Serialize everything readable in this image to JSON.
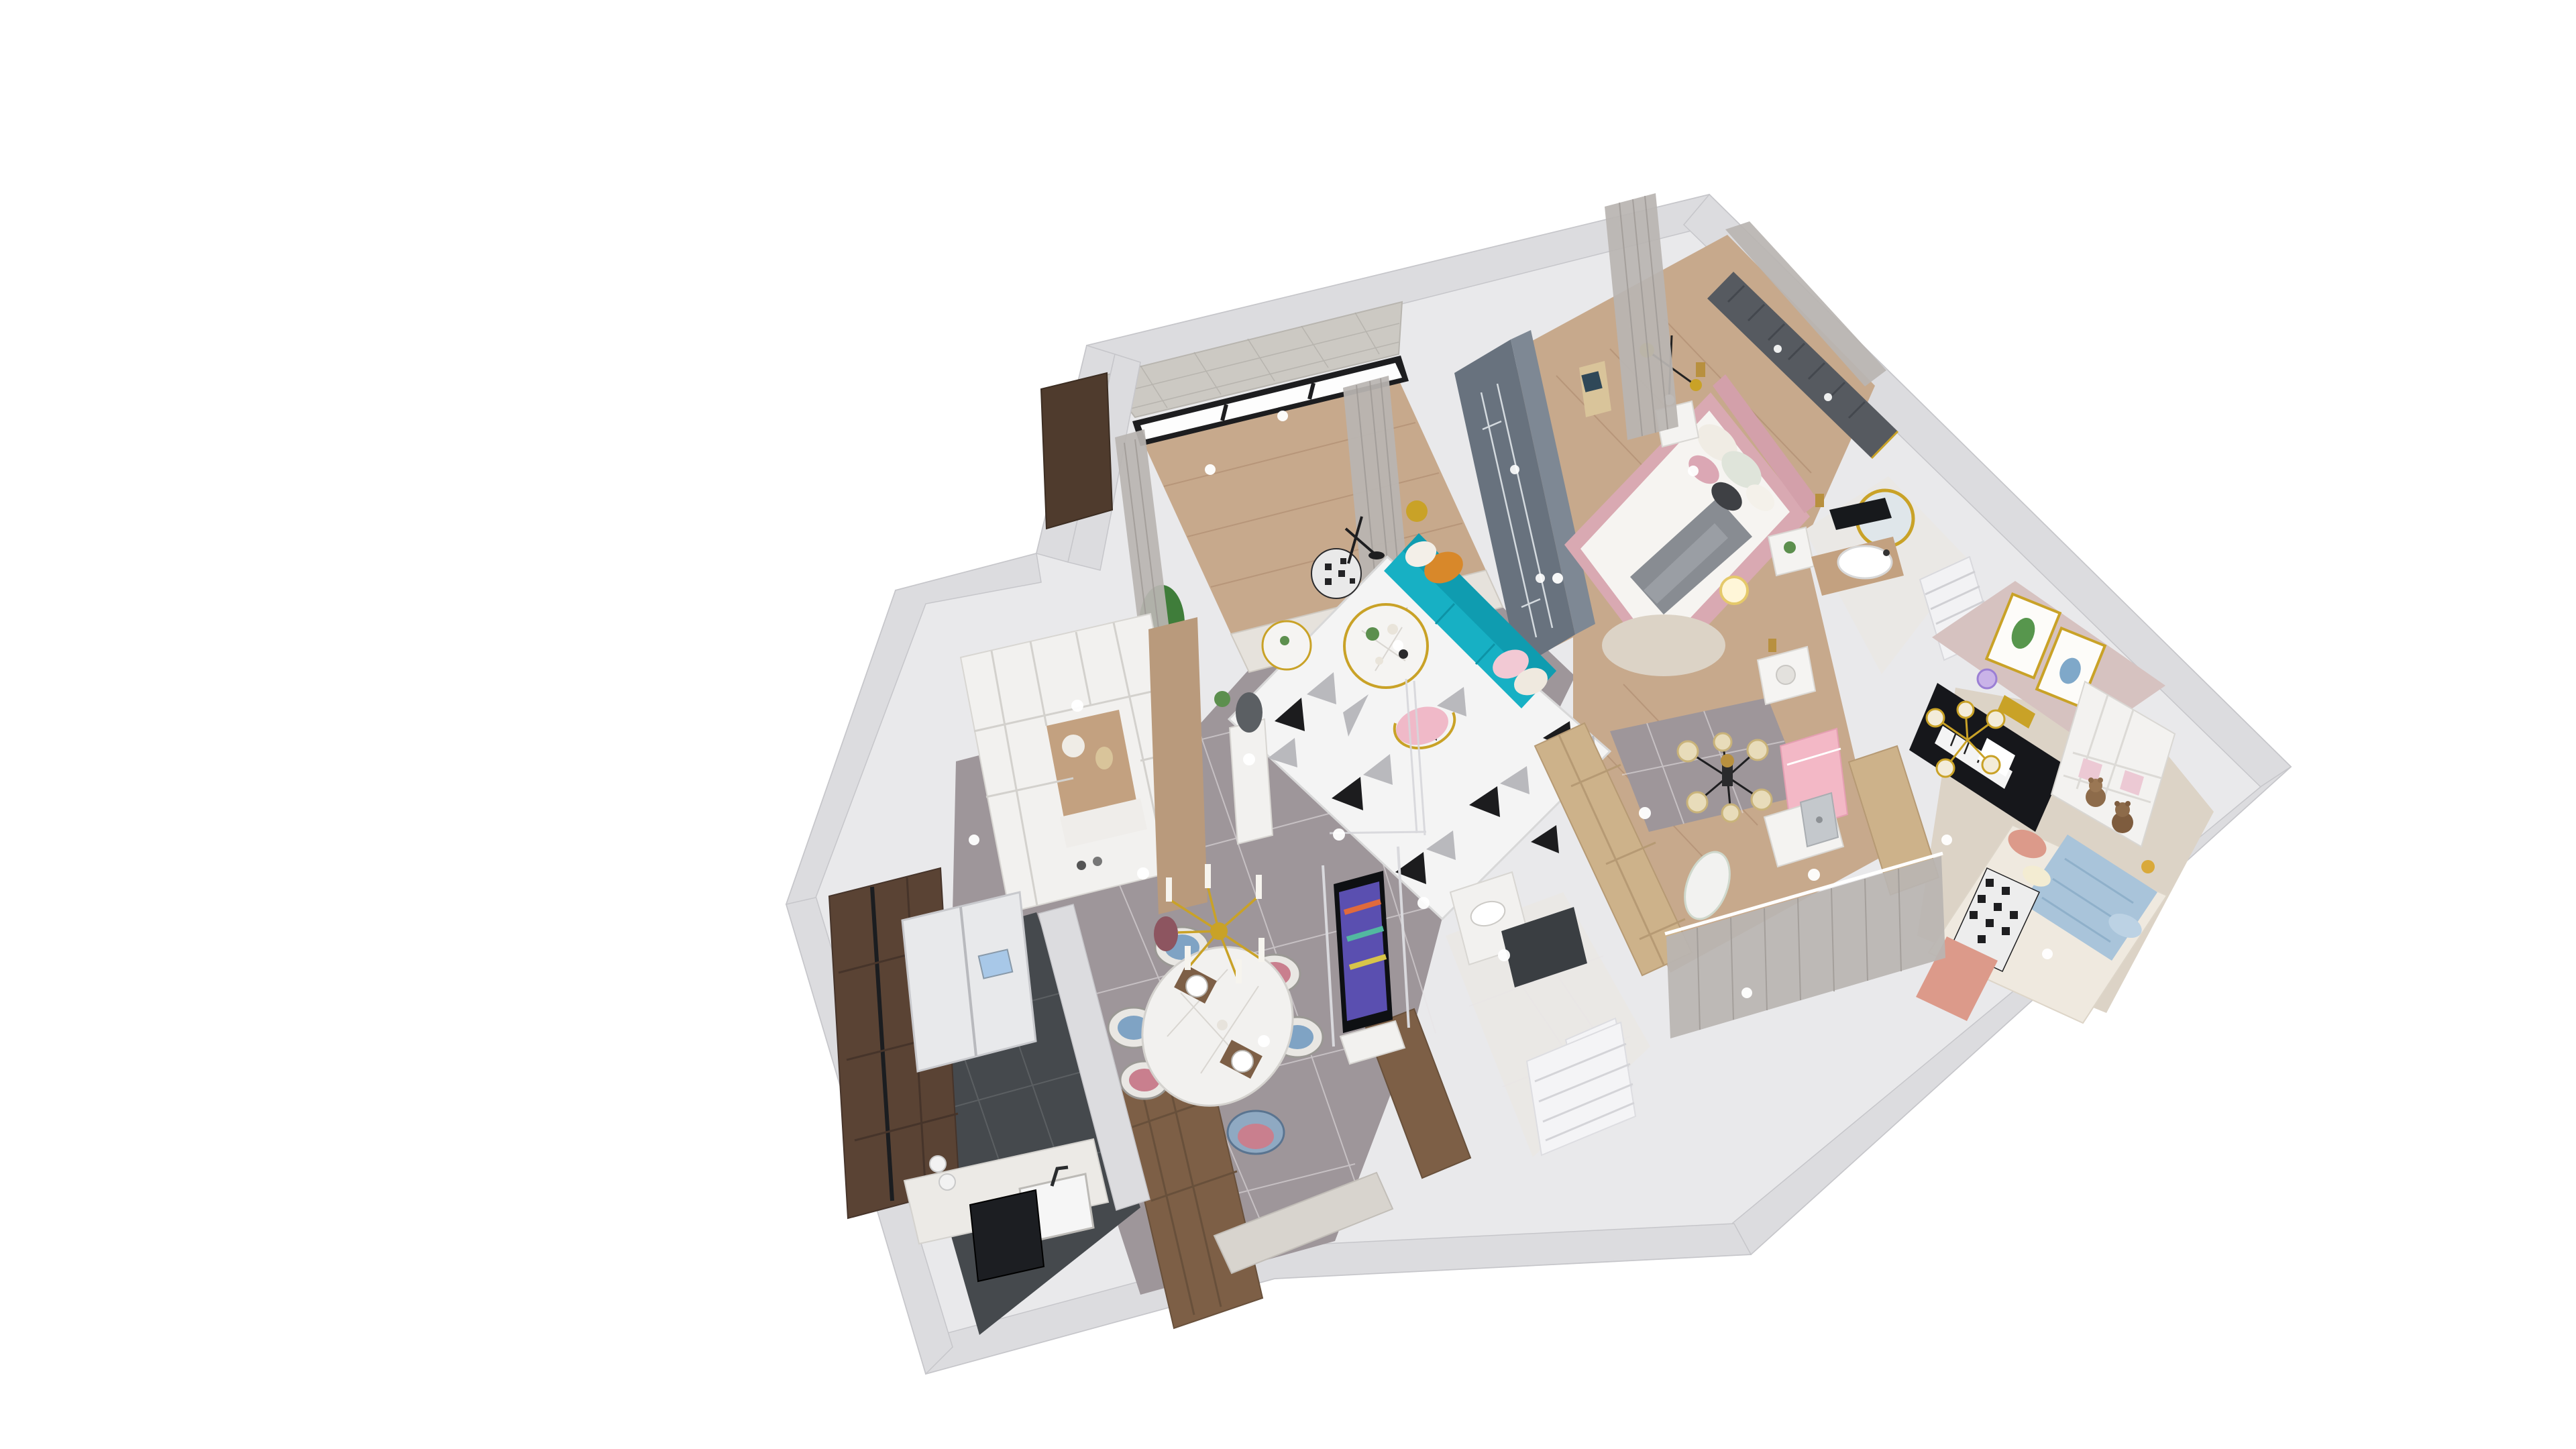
{
  "meta": {
    "title": "3D axonometric apartment floor plan render",
    "view": "top-down dollhouse cutaway, rotated ~20 degrees, white background",
    "visible_text": "none"
  },
  "palette": {
    "bg": "#ffffff",
    "wall": "#e9e9eb",
    "wallband": "#dcdcdf",
    "marble": "#9e969a",
    "darktile": "#45494d",
    "wood": "#c7a98c",
    "whitemarble": "#eae8e5",
    "carpet": "#dcd3c6",
    "bluegray": "#68727e",
    "teal": "#17b0c4",
    "gold": "#c9a227",
    "walnut": "#7d5f46",
    "pink": "#e7b6c0",
    "salmon": "#dc9a8a",
    "blue": "#a9c4da",
    "orange": "#d8882a",
    "piano": "#16171b",
    "slatwall": "#565a60"
  },
  "rooms": [
    {
      "name": "balcony",
      "floor": "wood planks",
      "items": [
        "floor-to-ceiling black-frame windows",
        "gray mosaic wall band",
        "sheer gray curtains",
        "potted plant",
        "dark walnut cabinet"
      ]
    },
    {
      "name": "living-room",
      "floor": "gray marble tile",
      "items": [
        "geometric black-white triangle rug",
        "teal three-seat sofa",
        "orange pillow",
        "pink and white pillows",
        "round marble coffee tables with gold legs",
        "houndstooth pouf",
        "pink wire chair with gold frame",
        "slate blue-gray feature wall",
        "floor lamp",
        "gold sphere decor"
      ]
    },
    {
      "name": "entry-hall",
      "floor": "gray marble tile",
      "items": [
        "white mudroom cabinet with wood niche",
        "hat and bag on hooks",
        "bench with shoes",
        "white pedestal with dark sculpture"
      ]
    },
    {
      "name": "master-bedroom",
      "floor": "wood planks",
      "items": [
        "pink upholstered bed with white duvet",
        "gray throw blanket",
        "pillow set",
        "dark gray slat headboard wall with gold trim",
        "white nightstand with photo frames",
        "black mobile chandelier with gold discs",
        "gold pendant lights",
        "cream round rug",
        "glowing drum lamp",
        "white side table with succulent",
        "window-bay seat",
        "gray curtains"
      ]
    },
    {
      "name": "master-bathroom",
      "floor": "white marble",
      "items": [
        "round gold-frame mirror",
        "white vessel sink on wood vanity",
        "black vanity tray",
        "white louvered shutters"
      ]
    },
    {
      "name": "kids-room",
      "floor": "cream carpet",
      "items": [
        "pink accent wall",
        "two gold-frame artworks (cactus, girl)",
        "black upright piano with sheet music",
        "gold bulb chandelier",
        "white cubby shelf with pink backs",
        "two teddy bears",
        "bed with houndstooth blanket",
        "salmon duvet",
        "light blue drape",
        "pillows"
      ]
    },
    {
      "name": "study-corridor",
      "floor": "wood planks with gray marble inset",
      "items": [
        "crystal chandelier",
        "white desk with silver computer",
        "pink wainscot wall",
        "light oak wardrobe band",
        "white appliance box with gold pendant",
        "gray partition curtain",
        "white slat radiator",
        "small white rug"
      ]
    },
    {
      "name": "second-bathroom",
      "floor": "white marble",
      "items": [
        "white marble vanity with basin",
        "dark stone counter slab",
        "white louvered partition screen"
      ]
    },
    {
      "name": "dining-room",
      "floor": "gray marble tile",
      "items": [
        "oval white marble dining table",
        "six woven chairs with blue and pink cushions",
        "gold sputnik candle chandelier",
        "place settings with plates and brown mats",
        "walnut partition cabinets",
        "low marble pony wall",
        "wall TV with colorful abstract screen on glass panel",
        "white media base"
      ]
    },
    {
      "name": "kitchen",
      "floor": "dark gray marble tile",
      "items": [
        "white side-by-side fridge with display",
        "dark walnut cabinet run with black counter",
        "white sink counter",
        "black built-in appliance",
        "dishware"
      ]
    }
  ],
  "lighting": [
    "recessed spot glints on floors",
    "wall downlights"
  ]
}
